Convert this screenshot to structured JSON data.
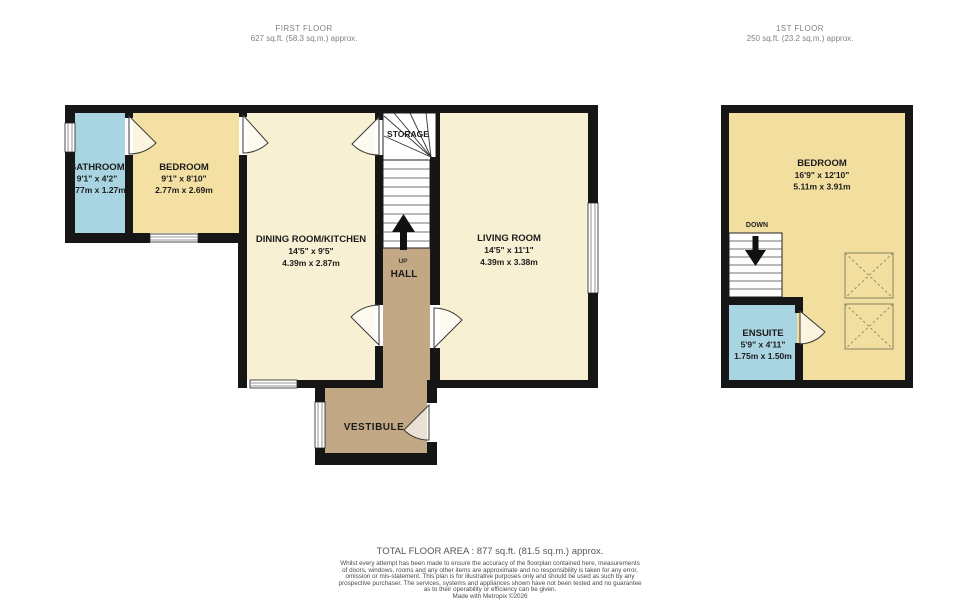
{
  "headers": {
    "first_floor": {
      "title": "FIRST FLOOR",
      "area": "627 sq.ft. (58.3 sq.m.) approx."
    },
    "upper_floor": {
      "title": "1ST FLOOR",
      "area": "250 sq.ft. (23.2 sq.m.) approx."
    }
  },
  "rooms": {
    "bathroom": {
      "name": "BATHROOM",
      "dims_ft": "9'1\" x 4'2\"",
      "dims_m": "2.77m x 1.27m"
    },
    "bedroom1": {
      "name": "BEDROOM",
      "dims_ft": "9'1\" x 8'10\"",
      "dims_m": "2.77m x 2.69m"
    },
    "dining": {
      "name": "DINING ROOM/KITCHEN",
      "dims_ft": "14'5\" x 9'5\"",
      "dims_m": "4.39m x 2.87m"
    },
    "living": {
      "name": "LIVING ROOM",
      "dims_ft": "14'5\" x 11'1\"",
      "dims_m": "4.39m x 3.38m"
    },
    "storage": {
      "name": "STORAGE"
    },
    "hall": {
      "name": "HALL",
      "up_label": "UP"
    },
    "vestibule": {
      "name": "VESTIBULE"
    },
    "bedroom2": {
      "name": "BEDROOM",
      "dims_ft": "16'9\" x 12'10\"",
      "dims_m": "5.11m x 3.91m"
    },
    "ensuite": {
      "name": "ENSUITE",
      "dims_ft": "5'9\" x 4'11\"",
      "dims_m": "1.75m x 1.50m"
    },
    "stairs_down_label": "DOWN"
  },
  "footer": {
    "total": "TOTAL FLOOR AREA : 877 sq.ft. (81.5 sq.m.) approx.",
    "disclaimer_lines": [
      "Whilst every attempt has been made to ensure the accuracy of the floorplan contained here, measurements",
      "of doors, windows, rooms and any other items are approximate and no responsibility is taken for any error,",
      "omission or mis-statement. This plan is for illustrative purposes only and should be used as such by any",
      "prospective purchaser. The services, systems and appliances shown have not been tested and no guarantee",
      "as to their operability or efficiency can be given."
    ],
    "credit": "Made with Metropix ©2026"
  },
  "colors": {
    "room_cream": "#f8f0d3",
    "room_yellow": "#f4e0a3",
    "room_blue": "#a9d4e1",
    "hall_brown": "#c2a885",
    "wall_black": "#161616",
    "header_gray": "#828282"
  }
}
